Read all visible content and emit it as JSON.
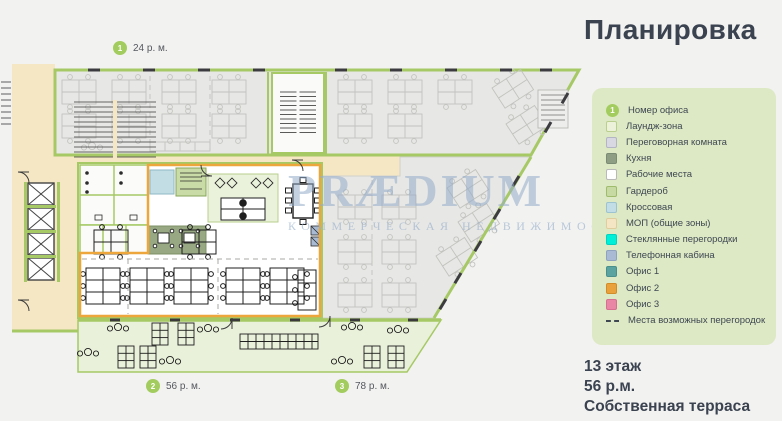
{
  "title": "Планировка",
  "watermark": {
    "brand": "PRÆDIUM",
    "tagline": "КОММЕРЧЕСКАЯ НЕДВИЖИМОСТЬ"
  },
  "markers": [
    {
      "number": "1",
      "label": "24 р. м."
    },
    {
      "number": "2",
      "label": "56 р. м."
    },
    {
      "number": "3",
      "label": "78 р. м."
    }
  ],
  "legend": {
    "items": [
      {
        "label": "Номер офиса",
        "swatch": "office-number-circle",
        "color": "#a3cc5e",
        "number": "1"
      },
      {
        "label": "Лаундж-зона",
        "swatch": "box",
        "color": "#ecf2da",
        "border": "#b9cf8e"
      },
      {
        "label": "Переговорная комната",
        "swatch": "box",
        "color": "#d7d8e2",
        "border": "#b4b5c4"
      },
      {
        "label": "Кухня",
        "swatch": "box",
        "color": "#8d9e85",
        "border": "#7b8c74"
      },
      {
        "label": "Рабочие места",
        "swatch": "box",
        "color": "#ffffff",
        "border": "#b9b9b9"
      },
      {
        "label": "Гардероб",
        "swatch": "box",
        "color": "#c8daa4",
        "border": "#9fbc6d"
      },
      {
        "label": "Кроссовая",
        "swatch": "box",
        "color": "#c2dde6",
        "border": "#9cc3cf"
      },
      {
        "label": "МОП (общие зоны)",
        "swatch": "box",
        "color": "#f4e6c5",
        "border": "#e0cd9e"
      },
      {
        "label": "Стеклянные перегородки",
        "swatch": "box",
        "color": "#00efd8",
        "border": "#00d4c0"
      },
      {
        "label": "Телефонная кабина",
        "swatch": "box",
        "color": "#a9bbd4",
        "border": "#8fa3c0"
      },
      {
        "label": "Офис 1",
        "swatch": "box",
        "color": "#5ba3a0",
        "border": "#4a8f8c"
      },
      {
        "label": "Офис 2",
        "swatch": "box",
        "color": "#e9a13b",
        "border": "#d18c28"
      },
      {
        "label": "Офис 3",
        "swatch": "box",
        "color": "#ea86a5",
        "border": "#d66f90"
      },
      {
        "label": "Места возможных перегородок",
        "swatch": "dashed-line",
        "color": "#3f4752"
      }
    ]
  },
  "info": {
    "floor": "13 этаж",
    "workplaces": "56 р.м.",
    "terrace": "Собственная терраса"
  },
  "plan_colors": {
    "walls_green": "#a6c965",
    "mop_cream": "#f5e7c4",
    "unavailable_gray": "#e7e7e5",
    "office2_border_orange": "#eda63c",
    "terrace_green": "#e9f1da",
    "kitchen_green": "#97a883",
    "lounge_green": "#ebf2dc",
    "cross_room_blue": "#c3dde5",
    "legend_bg": "#dde9c4",
    "heading_text": "#3b4350"
  }
}
